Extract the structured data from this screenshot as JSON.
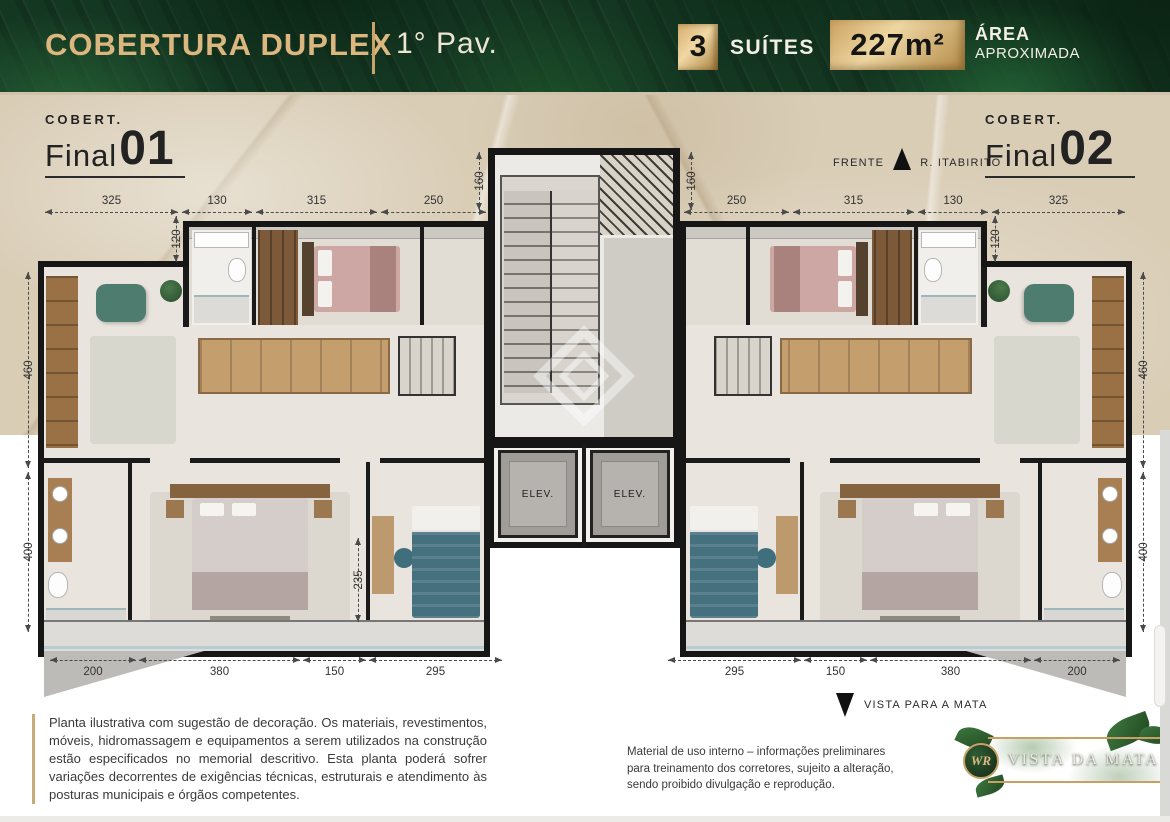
{
  "header": {
    "title": "COBERTURA DUPLEX",
    "floor": "1° Pav.",
    "suites_count": "3",
    "suites_label": "SUÍTES",
    "area_value": "227m²",
    "area_label_line1": "ÁREA",
    "area_label_line2": "APROXIMADA"
  },
  "units": {
    "left": {
      "small": "COBERT.",
      "word": "Final",
      "number": "01"
    },
    "right": {
      "small": "COBERT.",
      "word": "Final",
      "number": "02"
    }
  },
  "compass": {
    "front_label": "FRENTE",
    "street_label": "R. ITABIRITO"
  },
  "plan": {
    "elevators": [
      "ELEV.",
      "ELEV."
    ],
    "dims": {
      "top_left": [
        "325",
        "130",
        "315",
        "250"
      ],
      "top_right": [
        "250",
        "315",
        "130",
        "325"
      ],
      "bottom_left": [
        "200",
        "380",
        "150",
        "295"
      ],
      "bottom_right": [
        "295",
        "150",
        "380",
        "200"
      ],
      "side_left": [
        "460",
        "400"
      ],
      "side_right": [
        "460",
        "400"
      ],
      "top_vert_left": [
        "120",
        "160"
      ],
      "top_vert_right": [
        "160",
        "120"
      ],
      "inner_left": "235"
    }
  },
  "view_note": {
    "label": "VISTA PARA A MATA"
  },
  "disclaimer_main": "Planta ilustrativa com sugestão de decoração. Os materiais, revestimentos, móveis, hidromassagem e equipamentos a serem utilizados na construção estão especificados no memorial descritivo. Esta planta poderá sofrer variações decorrentes de exigências técnicas, estruturais e atendimento às posturas municipais e órgãos competentes.",
  "disclaimer_internal": "Material de uso interno – informações preliminares para treinamento dos corretores, sujeito a alteração, sendo proibido divulgação e reprodução.",
  "logo": {
    "monogram": "WR",
    "name": "VISTA DA MATA"
  }
}
